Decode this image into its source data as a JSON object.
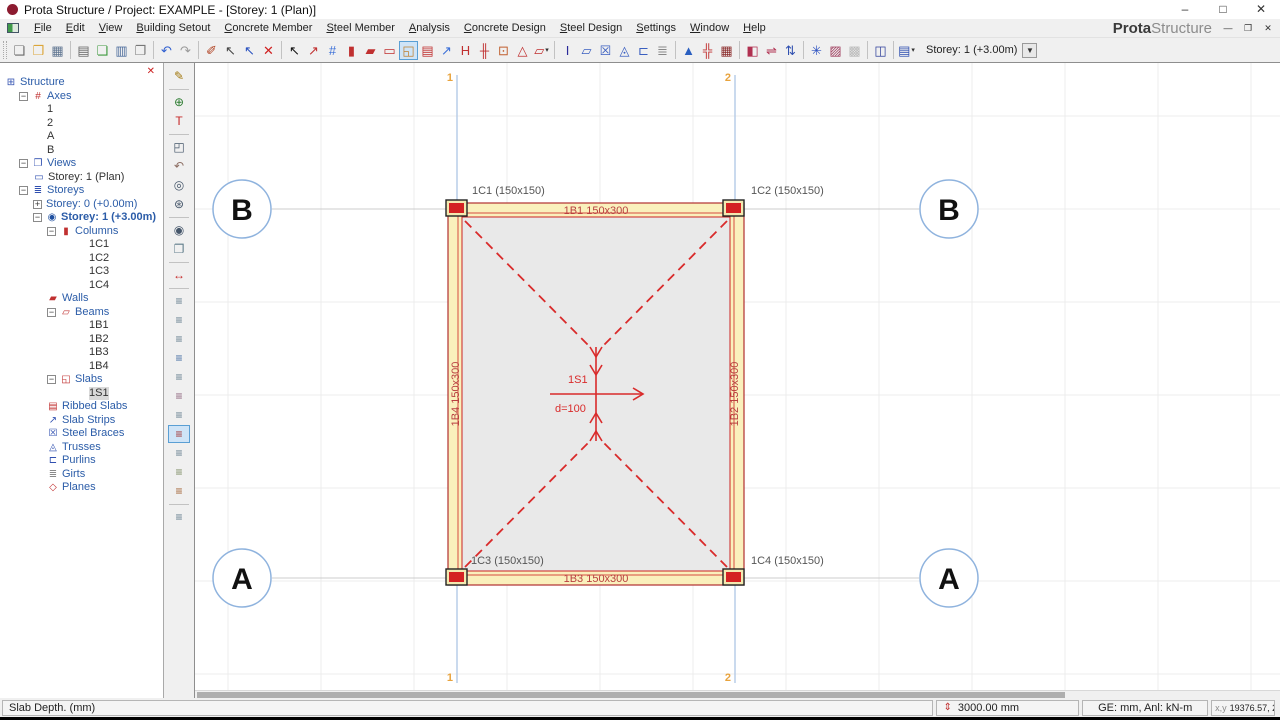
{
  "window": {
    "title": "Prota Structure / Project: EXAMPLE - [Storey: 1 (Plan)]",
    "minimize": "–",
    "maximize": "□",
    "close": "✕"
  },
  "brand": {
    "bold": "Prota",
    "light": "Structure"
  },
  "mdi": {
    "minimize": "—",
    "restore": "❐",
    "close": "✕"
  },
  "menus": [
    "File",
    "Edit",
    "View",
    "Building Setout",
    "Concrete Member",
    "Steel Member",
    "Analysis",
    "Concrete Design",
    "Steel Design",
    "Settings",
    "Window",
    "Help"
  ],
  "toolbar": {
    "items": [
      {
        "name": "new-file-button",
        "glyph": "❏",
        "color": "#6a6a6a"
      },
      {
        "name": "open-folder-button",
        "glyph": "❒",
        "color": "#dba63a"
      },
      {
        "name": "save-button",
        "glyph": "▦",
        "color": "#5e7490"
      },
      {
        "sep": true
      },
      {
        "name": "print-button",
        "glyph": "▤",
        "color": "#666666"
      },
      {
        "name": "export-report-button",
        "glyph": "❏",
        "color": "#3f9a3f"
      },
      {
        "name": "report-table-button",
        "glyph": "▥",
        "color": "#4a6a9a"
      },
      {
        "name": "page-copy-button",
        "glyph": "❐",
        "color": "#777777"
      },
      {
        "sep": true
      },
      {
        "name": "undo-button",
        "glyph": "↶",
        "color": "#2f5fd0"
      },
      {
        "name": "redo-button",
        "glyph": "↷",
        "color": "#9a9a9a"
      },
      {
        "sep": true
      },
      {
        "name": "edit-member-tool",
        "glyph": "✐",
        "color": "#b04020"
      },
      {
        "name": "deselect-tool",
        "glyph": "↖",
        "color": "#444444"
      },
      {
        "name": "select-filter-tool",
        "glyph": "↖",
        "color": "#2a52c0"
      },
      {
        "name": "delete-button",
        "glyph": "✕",
        "color": "#d02020"
      },
      {
        "sep": true
      },
      {
        "name": "select-pointer-tool",
        "glyph": "↖",
        "color": "#111111"
      },
      {
        "name": "member-line-tool",
        "glyph": "↗",
        "color": "#c03030"
      },
      {
        "name": "axes-tool",
        "glyph": "#",
        "color": "#3a6fd8"
      },
      {
        "name": "column-tool",
        "glyph": "▮",
        "color": "#c03030"
      },
      {
        "name": "wall-tool",
        "glyph": "▰",
        "color": "#c03030"
      },
      {
        "name": "beam-tool",
        "glyph": "▭",
        "color": "#c03030"
      },
      {
        "name": "slab-tool",
        "glyph": "◱",
        "color": "#c08030",
        "selected": true
      },
      {
        "name": "ribbed-slab-tool",
        "glyph": "▤",
        "color": "#c03030"
      },
      {
        "name": "slab-strip-tool",
        "glyph": "↗",
        "color": "#3a6fd8"
      },
      {
        "name": "steel-beam-tool",
        "glyph": "H",
        "color": "#c03030"
      },
      {
        "name": "steel-column-tool",
        "glyph": "╫",
        "color": "#c03030"
      },
      {
        "name": "node-move-tool",
        "glyph": "⊡",
        "color": "#c06030"
      },
      {
        "name": "plane-tool",
        "glyph": "△",
        "color": "#c03030"
      },
      {
        "name": "polyline-tool",
        "glyph": "▱",
        "color": "#c03030",
        "dropdown": true
      },
      {
        "sep": true
      },
      {
        "name": "i-section-tool",
        "glyph": "I",
        "color": "#2a2a9a"
      },
      {
        "name": "shear-panel-tool",
        "glyph": "▱",
        "color": "#3a5fc0"
      },
      {
        "name": "brace-tool",
        "glyph": "☒",
        "color": "#3a5fc0"
      },
      {
        "name": "truss-tool",
        "glyph": "◬",
        "color": "#3a5fc0"
      },
      {
        "name": "purlin-tool",
        "glyph": "⊏",
        "color": "#3a5fc0"
      },
      {
        "name": "girt-tool",
        "glyph": "≣",
        "color": "#888888"
      },
      {
        "sep": true
      },
      {
        "name": "elevations-tool",
        "glyph": "▲",
        "color": "#2a5fc0"
      },
      {
        "name": "analysis-grid-tool",
        "glyph": "╬",
        "color": "#c03030"
      },
      {
        "name": "building-analysis-tool",
        "glyph": "▦",
        "color": "#8a2a2a"
      },
      {
        "sep": true
      },
      {
        "name": "display-options-button",
        "glyph": "◧",
        "color": "#b03050"
      },
      {
        "name": "beam-update-tool",
        "glyph": "⇌",
        "color": "#b03050"
      },
      {
        "name": "column-update-tool",
        "glyph": "⇅",
        "color": "#3050b0"
      },
      {
        "sep": true
      },
      {
        "name": "freeze-view-button",
        "glyph": "✳",
        "color": "#2a50c0"
      },
      {
        "name": "detail-view-button",
        "glyph": "▨",
        "color": "#a04060"
      },
      {
        "name": "grid-off-button",
        "glyph": "▩",
        "color": "#b8b8b8"
      },
      {
        "sep": true
      },
      {
        "name": "table-view-button",
        "glyph": "◫",
        "color": "#30409a"
      },
      {
        "sep": true
      },
      {
        "name": "storey-tool-button",
        "glyph": "▤",
        "color": "#3050b0",
        "dropdown": true
      }
    ],
    "storey_selector": "Storey: 1 (+3.00m)",
    "combo_caret": "▼"
  },
  "side_toolbar": {
    "items": [
      {
        "name": "sketch-tool",
        "glyph": "✎",
        "color": "#a0760a"
      },
      {
        "sep": true
      },
      {
        "name": "snap-target-tool",
        "glyph": "⊕",
        "color": "#2e7d32"
      },
      {
        "name": "text-dimension-tool",
        "glyph": "T",
        "color": "#c62828"
      },
      {
        "sep": true
      },
      {
        "name": "zoom-window-tool",
        "glyph": "◰",
        "color": "#45566a"
      },
      {
        "name": "zoom-previous-tool",
        "glyph": "↶",
        "color": "#8d6e63"
      },
      {
        "name": "zoom-extents-tool",
        "glyph": "◎",
        "color": "#45566a"
      },
      {
        "name": "zoom-in-tool",
        "glyph": "⊛",
        "color": "#45566a"
      },
      {
        "sep": true
      },
      {
        "name": "view-options-tool",
        "glyph": "◉",
        "color": "#45566a"
      },
      {
        "name": "copy-elements-tool",
        "glyph": "❐",
        "color": "#607d8b"
      },
      {
        "sep": true
      },
      {
        "name": "dimension-tool",
        "glyph": "↔",
        "color": "#c62828"
      },
      {
        "sep": true
      },
      {
        "name": "visibility-columns-toggle",
        "glyph": "≡",
        "color": "#5f7a8a"
      },
      {
        "name": "visibility-walls-toggle",
        "glyph": "≡",
        "color": "#5f7a8a"
      },
      {
        "name": "visibility-beams-toggle",
        "glyph": "≡",
        "color": "#5f7a8a"
      },
      {
        "name": "visibility-slabs-toggle",
        "glyph": "≡",
        "color": "#3f6aa0"
      },
      {
        "name": "visibility-ribbed-toggle",
        "glyph": "≡",
        "color": "#5f7a8a"
      },
      {
        "name": "visibility-strips-toggle",
        "glyph": "≡",
        "color": "#8a5f7a"
      },
      {
        "name": "visibility-loads-toggle",
        "glyph": "≡",
        "color": "#5f7a8a"
      },
      {
        "name": "visibility-braces-toggle",
        "glyph": "≡",
        "color": "#a03030",
        "selected": true
      },
      {
        "name": "visibility-trusses-toggle",
        "glyph": "≡",
        "color": "#5f7a8a"
      },
      {
        "name": "visibility-purlins-toggle",
        "glyph": "≡",
        "color": "#7a8a5f"
      },
      {
        "name": "visibility-girts-toggle",
        "glyph": "≡",
        "color": "#a05f30"
      },
      {
        "sep": true
      },
      {
        "name": "visibility-locks-toggle",
        "glyph": "≡",
        "color": "#5f7a8a"
      }
    ]
  },
  "tree": {
    "rows": [
      {
        "depth": 0,
        "icon": "structure",
        "glyph": "⊞",
        "icon_color": "#3050b0",
        "label": "Structure",
        "cat": true
      },
      {
        "depth": 1,
        "expand": "-",
        "icon": "axes",
        "glyph": "#",
        "icon_color": "#c03030",
        "label": "Axes",
        "cat": true
      },
      {
        "depth": 3,
        "label": "1"
      },
      {
        "depth": 3,
        "label": "2"
      },
      {
        "depth": 3,
        "label": "A"
      },
      {
        "depth": 3,
        "label": "B"
      },
      {
        "depth": 1,
        "expand": "-",
        "icon": "views",
        "glyph": "❐",
        "icon_color": "#3050b0",
        "label": "Views",
        "cat": true
      },
      {
        "depth": 2,
        "icon": "view-plan",
        "glyph": "▭",
        "icon_color": "#3050b0",
        "label": "Storey: 1 (Plan)"
      },
      {
        "depth": 1,
        "expand": "-",
        "icon": "storeys",
        "glyph": "≣",
        "icon_color": "#3050b0",
        "label": "Storeys",
        "cat": true
      },
      {
        "depth": 2,
        "expand": "+",
        "label": "Storey: 0 (+0.00m)",
        "cat": true
      },
      {
        "depth": 2,
        "expand": "-",
        "icon": "current-storey",
        "glyph": "◉",
        "icon_color": "#2050a0",
        "label": "Storey: 1 (+3.00m)",
        "cat": true,
        "bold": true
      },
      {
        "depth": 3,
        "expand": "-",
        "icon": "columns",
        "glyph": "▮",
        "icon_color": "#c03030",
        "label": "Columns",
        "cat": true
      },
      {
        "depth": 6,
        "label": "1C1"
      },
      {
        "depth": 6,
        "label": "1C2"
      },
      {
        "depth": 6,
        "label": "1C3"
      },
      {
        "depth": 6,
        "label": "1C4"
      },
      {
        "depth": 3,
        "icon": "walls",
        "glyph": "▰",
        "icon_color": "#c03030",
        "label": "Walls",
        "cat": true
      },
      {
        "depth": 3,
        "expand": "-",
        "icon": "beams",
        "glyph": "▱",
        "icon_color": "#c03030",
        "label": "Beams",
        "cat": true
      },
      {
        "depth": 6,
        "label": "1B1"
      },
      {
        "depth": 6,
        "label": "1B2"
      },
      {
        "depth": 6,
        "label": "1B3"
      },
      {
        "depth": 6,
        "label": "1B4"
      },
      {
        "depth": 3,
        "expand": "-",
        "icon": "slabs",
        "glyph": "◱",
        "icon_color": "#c03030",
        "label": "Slabs",
        "cat": true
      },
      {
        "depth": 6,
        "label": "1S1",
        "selected": true
      },
      {
        "depth": 3,
        "icon": "ribbed-slabs",
        "glyph": "▤",
        "icon_color": "#c03030",
        "label": "Ribbed Slabs",
        "cat": true
      },
      {
        "depth": 3,
        "icon": "slab-strips",
        "glyph": "↗",
        "icon_color": "#3050b0",
        "label": "Slab Strips",
        "cat": true
      },
      {
        "depth": 3,
        "icon": "steel-braces",
        "glyph": "☒",
        "icon_color": "#3050b0",
        "label": "Steel Braces",
        "cat": true
      },
      {
        "depth": 3,
        "icon": "trusses",
        "glyph": "◬",
        "icon_color": "#3050b0",
        "label": "Trusses",
        "cat": true
      },
      {
        "depth": 3,
        "icon": "purlins",
        "glyph": "⊏",
        "icon_color": "#3050b0",
        "label": "Purlins",
        "cat": true
      },
      {
        "depth": 3,
        "icon": "girts",
        "glyph": "≣",
        "icon_color": "#8a8a8a",
        "label": "Girts",
        "cat": true
      },
      {
        "depth": 3,
        "icon": "planes",
        "glyph": "◇",
        "icon_color": "#c03030",
        "label": "Planes",
        "cat": true
      }
    ],
    "close_glyph": "✕"
  },
  "canvas": {
    "axis_numbers": [
      "1",
      "2"
    ],
    "bubbles": [
      {
        "label": "B"
      },
      {
        "label": "B"
      },
      {
        "label": "A"
      },
      {
        "label": "A"
      }
    ],
    "plan": {
      "columns": [
        {
          "label": "1C1 (150x150)"
        },
        {
          "label": "1C2 (150x150)"
        },
        {
          "label": "1C3 (150x150)"
        },
        {
          "label": "1C4 (150x150)"
        }
      ],
      "beams": [
        {
          "label": "1B1 150x300"
        },
        {
          "label": "1B2 150x300"
        },
        {
          "label": "1B3 150x300"
        },
        {
          "label": "1B4 150x300"
        }
      ],
      "slab": {
        "label": "1S1",
        "depth": "d=100"
      }
    },
    "colors": {
      "beam_fill": "#faf0bc",
      "beam_edge": "#b03030",
      "slab_fill": "#e9e9e9",
      "red": "#d92b2b",
      "axis_blue": "#b9cde8",
      "bubble_blue": "#8fb3de",
      "label_orange": "#e8a33d"
    }
  },
  "statusbar": {
    "hint": "Slab Depth. (mm)",
    "height_icon": "⇕",
    "storey_height": "3000.00 mm",
    "units": "GE: mm,  Anl: kN-m",
    "coord_prefix": "x,y",
    "coords": "19376.57, 20204.50"
  }
}
